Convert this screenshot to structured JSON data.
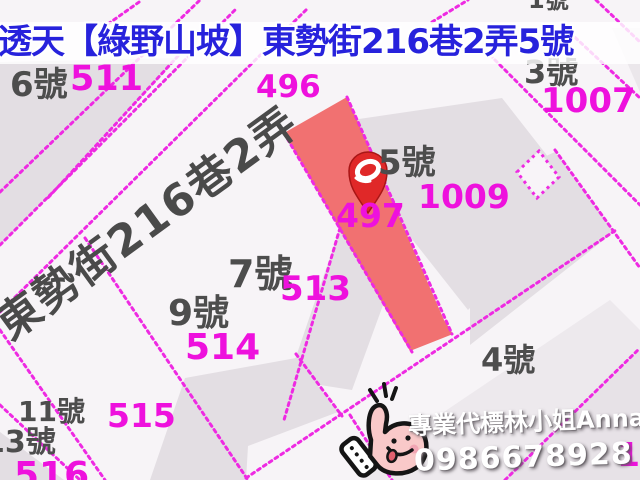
{
  "title": {
    "text": "透天【綠野山坡】東勢街216巷2弄5號"
  },
  "map": {
    "street_label": "東勢街216巷2弄",
    "marker": {
      "type": "location-pin",
      "on_parcel": "497"
    },
    "labels": [
      {
        "text": "6號",
        "kind": "house",
        "x": 10,
        "y": 68,
        "size": 34
      },
      {
        "text": "3號",
        "kind": "house",
        "x": 524,
        "y": 56,
        "size": 32
      },
      {
        "text": "5號",
        "kind": "house",
        "x": 378,
        "y": 146,
        "size": 34
      },
      {
        "text": "7號",
        "kind": "house",
        "x": 228,
        "y": 255,
        "size": 38
      },
      {
        "text": "9號",
        "kind": "house",
        "x": 168,
        "y": 296,
        "size": 36
      },
      {
        "text": "4號",
        "kind": "house",
        "x": 481,
        "y": 344,
        "size": 32
      },
      {
        "text": "11號",
        "kind": "house",
        "x": 18,
        "y": 398,
        "size": 28
      },
      {
        "text": "13號",
        "kind": "house",
        "x": -16,
        "y": 428,
        "size": 30
      },
      {
        "text": "1號",
        "kind": "house",
        "x": 528,
        "y": -12,
        "size": 24
      },
      {
        "text": "511",
        "kind": "parcel",
        "x": 70,
        "y": 62,
        "size": 35
      },
      {
        "text": "496",
        "kind": "parcel",
        "x": 256,
        "y": 72,
        "size": 31
      },
      {
        "text": "1007",
        "kind": "parcel",
        "x": 541,
        "y": 84,
        "size": 34
      },
      {
        "text": "1009",
        "kind": "parcel",
        "x": 418,
        "y": 180,
        "size": 33
      },
      {
        "text": "497",
        "kind": "parcel",
        "x": 336,
        "y": 199,
        "size": 33
      },
      {
        "text": "513",
        "kind": "parcel",
        "x": 280,
        "y": 272,
        "size": 34
      },
      {
        "text": "514",
        "kind": "parcel",
        "x": 185,
        "y": 330,
        "size": 36
      },
      {
        "text": "515",
        "kind": "parcel",
        "x": 107,
        "y": 399,
        "size": 33
      },
      {
        "text": "516",
        "kind": "parcel",
        "x": 14,
        "y": 458,
        "size": 36
      },
      {
        "text": "101",
        "kind": "parcel",
        "x": 617,
        "y": 438,
        "size": 33
      }
    ],
    "colors": {
      "boundary_line": "#ee2ae2",
      "parcel_number": "#ee11dd",
      "house_number": "#4d4d4d",
      "highlighted_parcel": "#f17171",
      "pin": "#e02828",
      "title_blue": "#2722dc"
    }
  },
  "watermark": {
    "agent": "專業代標林小姐Anna",
    "phone": "0986678928"
  }
}
